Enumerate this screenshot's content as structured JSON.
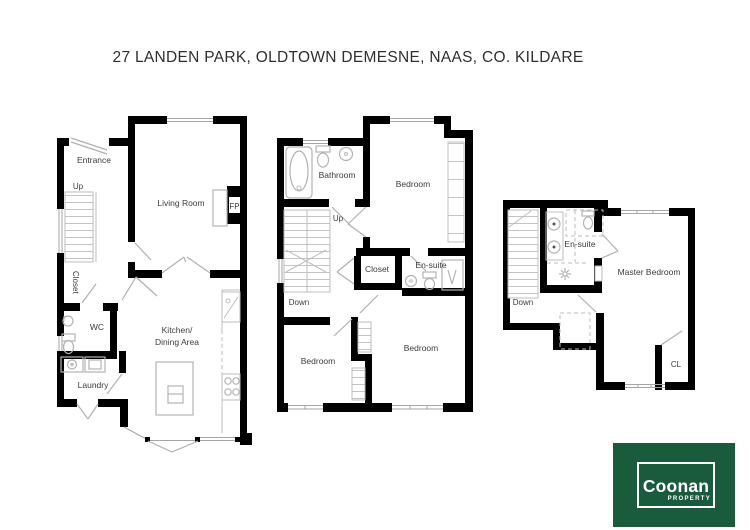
{
  "title": "27 LANDEN PARK, OLDTOWN DEMESNE, NAAS, CO. KILDARE",
  "plans": {
    "ground": {
      "entrance": "Entrance",
      "up": "Up",
      "living_room": "Living Room",
      "fireplace": "FP",
      "closet": "Closet",
      "wc": "WC",
      "laundry": "Laundry",
      "kitchen_line1": "Kitchen/",
      "kitchen_line2": "Dining Area"
    },
    "first": {
      "bathroom": "Bathroom",
      "bedroom_top": "Bedroom",
      "up": "Up",
      "down": "Down",
      "closet": "Closet",
      "ensuite": "En-suite",
      "bedroom_left": "Bedroom",
      "bedroom_right": "Bedroom"
    },
    "second": {
      "ensuite": "En-suite",
      "master_bedroom": "Master Bedroom",
      "down": "Down",
      "closet_cl": "CL"
    }
  },
  "logo": {
    "brand": "Coonan",
    "tagline": "PROPERTY",
    "background": "#1b5b3d",
    "foreground": "#ffffff"
  },
  "colors": {
    "wall": "#000000",
    "fixture": "#b3b3b3",
    "label": "#3c3c3c",
    "title": "#2f2f2f"
  }
}
